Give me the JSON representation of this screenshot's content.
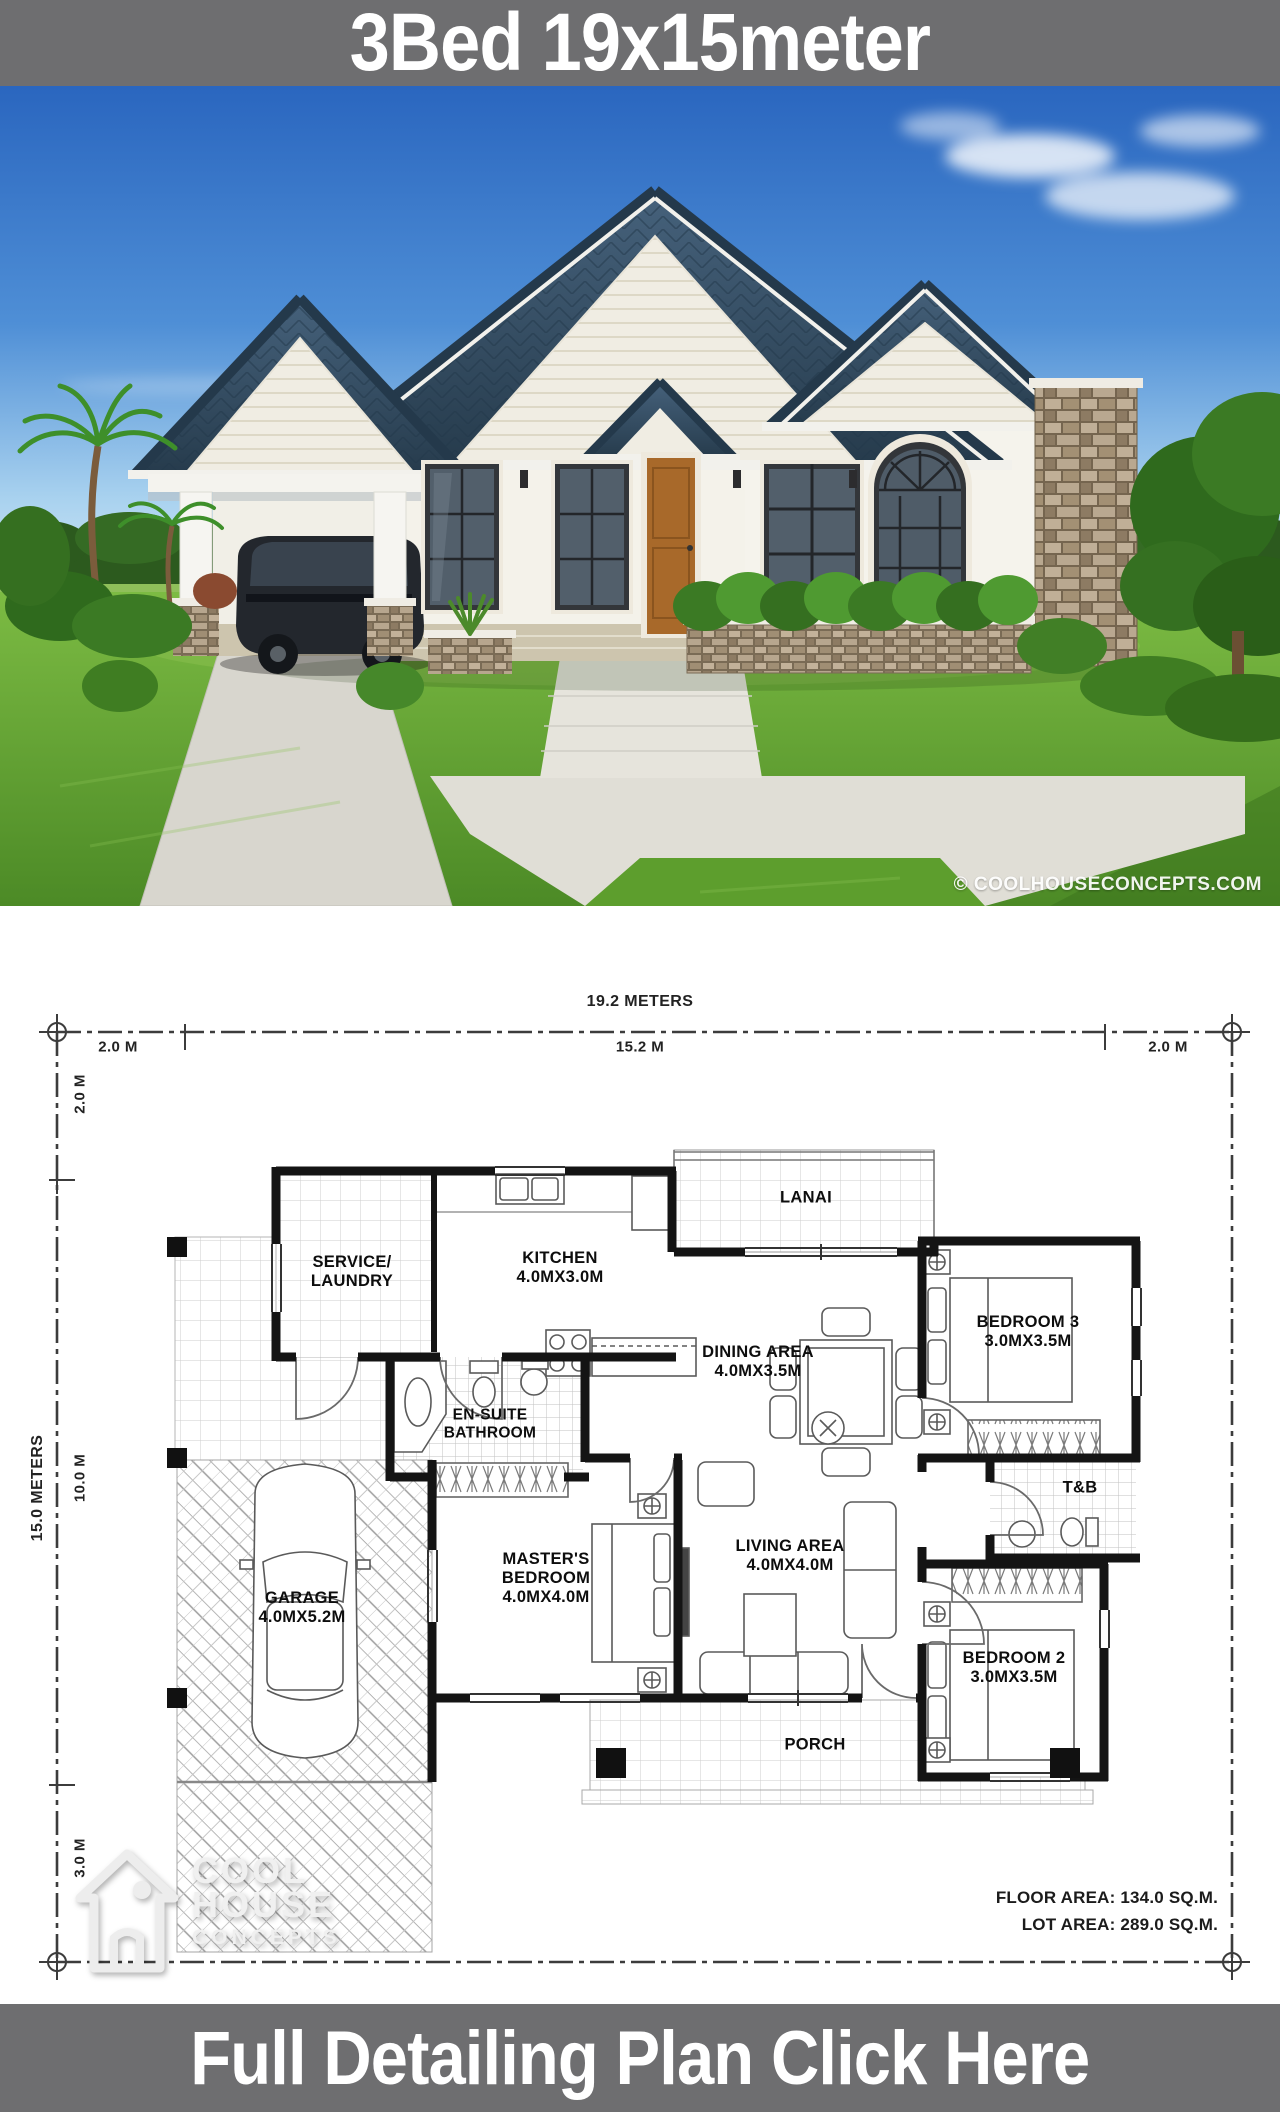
{
  "banners": {
    "top": {
      "title": "3Bed 19x15meter",
      "bg": "#6e6e70",
      "fg": "#ffffff"
    },
    "bottom": {
      "title": "Full Detailing Plan Click Here",
      "bg": "#6e6e70",
      "fg": "#ffffff"
    }
  },
  "photo": {
    "watermark": "© COOLHOUSECONCEPTS.COM",
    "colors": {
      "sky_top": "#2a66bf",
      "sky_horizon": "#dfeef9",
      "roof": "#35506b",
      "wall": "#f4f2ea",
      "accent_band": "#cdc5ae",
      "grass": "#64a832",
      "stone": "#ab9981",
      "door": "#a8692a"
    }
  },
  "floor_plan": {
    "dimensions": {
      "top_total": "19.2 METERS",
      "top_left": "2.0 M",
      "top_mid": "15.2 M",
      "top_right": "2.0 M",
      "side_total": "15.0 METERS",
      "side_top": "2.0 M",
      "side_mid": "10.0 M",
      "side_bottom": "3.0 M"
    },
    "rooms": {
      "service": {
        "l1": "SERVICE/",
        "l2": "LAUNDRY"
      },
      "kitchen": {
        "l1": "KITCHEN",
        "l2": "4.0MX3.0M"
      },
      "lanai": {
        "l1": "LANAI"
      },
      "bedroom3": {
        "l1": "BEDROOM 3",
        "l2": "3.0MX3.5M"
      },
      "dining": {
        "l1": "DINING AREA",
        "l2": "4.0MX3.5M"
      },
      "ensuite": {
        "l1": "EN-SUITE",
        "l2": "BATHROOM"
      },
      "tb": {
        "l1": "T&B"
      },
      "master": {
        "l1": "MASTER'S",
        "l2": "BEDROOM",
        "l3": "4.0MX4.0M"
      },
      "living": {
        "l1": "LIVING AREA",
        "l2": "4.0MX4.0M"
      },
      "garage": {
        "l1": "GARAGE",
        "l2": "4.0MX5.2M"
      },
      "bedroom2": {
        "l1": "BEDROOM 2",
        "l2": "3.0MX3.5M"
      },
      "porch": {
        "l1": "PORCH"
      }
    },
    "areas": {
      "floor": "FLOOR AREA: 134.0 SQ.M.",
      "lot": "LOT AREA: 289.0 SQ.M."
    },
    "logo": {
      "l1": "COOL",
      "l2": "HOUSE",
      "l3": "CONCEPTS"
    }
  }
}
